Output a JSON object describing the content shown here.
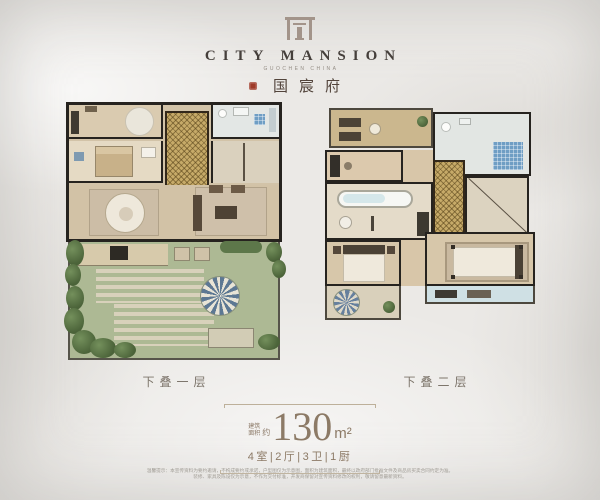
{
  "header": {
    "brand": "CITY MANSION",
    "brand_tagline": "GUOCHEN CHINA",
    "cn_name": "国宸府"
  },
  "plans": {
    "left_label": "下叠一层",
    "right_label": "下叠二层"
  },
  "spec": {
    "area_prefix_line1": "建筑",
    "area_prefix_line2": "面积",
    "area_approx": "约",
    "area_value": "130",
    "area_unit": "m²",
    "rooms": "4室|2厅|3卫|1厨"
  },
  "footer": {
    "disclaimer_line1": "温馨提示：本宣传资料为要约邀请，不构成要约或承诺，户型图仅为示意图，面积为建筑面积，最终以政府部门批准文件及商品房买卖合同约定为准。",
    "disclaimer_line2": "装修、家具及陈设仅为示意，不作为交付标准，开发商保留对宣传资料修改的权利，敬请留意最新资料。"
  },
  "colors": {
    "accent_gold": "#c6aa68",
    "seal_red": "#9e3a29",
    "text_brown": "#8c7a66",
    "wall_dark": "#26231f",
    "lawn_green": "#adb994",
    "background": "#ebe9e6"
  }
}
